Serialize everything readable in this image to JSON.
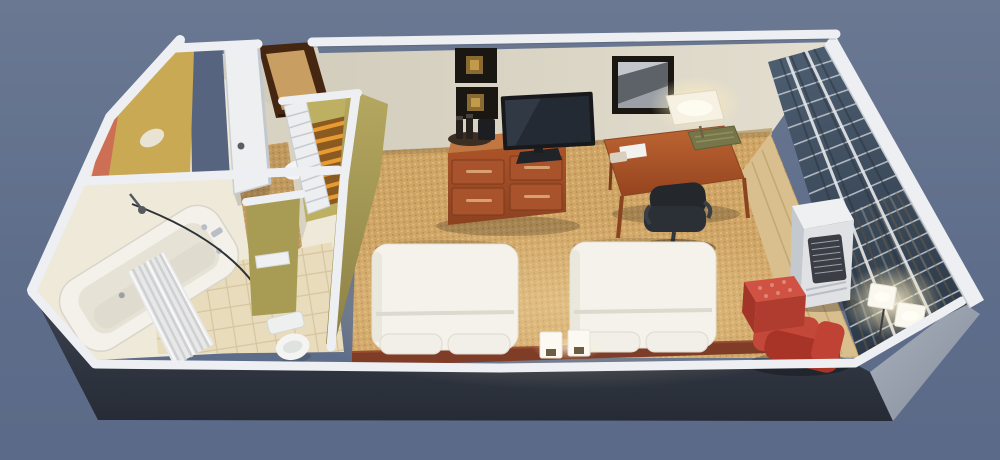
{
  "scene": {
    "type": "3d-floorplan-cutaway-render",
    "room": "hotel-guest-room",
    "objects": [
      "entry-door",
      "entry-doorway",
      "vanity-counter",
      "bathtub",
      "shower-curtain",
      "shower-head",
      "curtain-rod",
      "toilet",
      "wall-shelf",
      "closet",
      "louver-door",
      "luggage-rack",
      "laundry-bag",
      "bed-1",
      "bed-2",
      "pillows",
      "headboard-shelf",
      "bedside-lamp-1",
      "bedside-lamp-2",
      "dresser",
      "coffee-tray",
      "tv",
      "wall-art-top",
      "wall-art-bottom",
      "framed-photo",
      "desk",
      "desk-lamp",
      "desk-tray",
      "notepad",
      "telephone",
      "office-chair",
      "ptac-ac-unit",
      "ottoman",
      "armchair",
      "floor-lamp",
      "window-wall",
      "window-blinds",
      "carpet",
      "hallway-carpet",
      "tile-floor",
      "wood-floor",
      "exterior-walls",
      "wall-caps"
    ]
  },
  "colors": {
    "bg_top": "#6a7892",
    "bg_bottom": "#5a6a88",
    "bg_doorgap": "#57647f",
    "exterior_dark": "#3a414e",
    "exterior_darker": "#272c37",
    "exterior_right": "#97a0ad",
    "wall_cap": "#edeff2",
    "wall_cream": "#d8d2c2",
    "wall_cream_light": "#e9e4d6",
    "bath_base": "#efe9da",
    "baseboard": "#c0ab7e",
    "olive": "#b2a55e",
    "olive_dark": "#8f8448",
    "olive_nook": "#a89c55",
    "olive_closet": "#bdb062",
    "mustard": "#c9a953",
    "accent_red": "#cd6f55",
    "carpet": "#d0a667",
    "carpet_dot_light": "#e4bf82",
    "carpet_dot_dark": "#b1854b",
    "tile": "#e9dcbd",
    "tile_line": "#d5c5a0",
    "wood_floor": "#d9be8e",
    "cherry": "#a8532b",
    "cherry_light": "#c07742",
    "cherry_dark": "#7c3a1d",
    "headboard": "#7f3d28",
    "bed_white": "#f4f2ea",
    "pillow": "#f1efe8",
    "linen_shadow": "#dcd9cf",
    "porcelain": "#f4f5f2",
    "chrome": "#b9bfc7",
    "tv_screen": "#242a33",
    "tv_bezel": "#17191d",
    "frame_black": "#1a1713",
    "art_gold": "#8a6a33",
    "art_gold_light": "#c19a4a",
    "photo_gray": "#c3c7cb",
    "photo_dark": "#5d6268",
    "chair_black": "#2b2f36",
    "lamp_shade": "#f6f1e2",
    "glow": "#fff3d0",
    "red_chair": "#c4483a",
    "red_chair_dark": "#a83327",
    "red_ottoman": "#cf5242",
    "ac_body": "#dfe1e5",
    "ac_grille": "#3b3f45",
    "glass_top": "#4c5d70",
    "glass_bottom": "#2c3947",
    "blind_slat": "#c3c9d1",
    "curtain_stripe": "#8a7a5e",
    "door_white": "#edeff1",
    "doorway_brown": "#452711",
    "rack_orange": "#e89a33",
    "rack_base": "#8a5a20"
  }
}
